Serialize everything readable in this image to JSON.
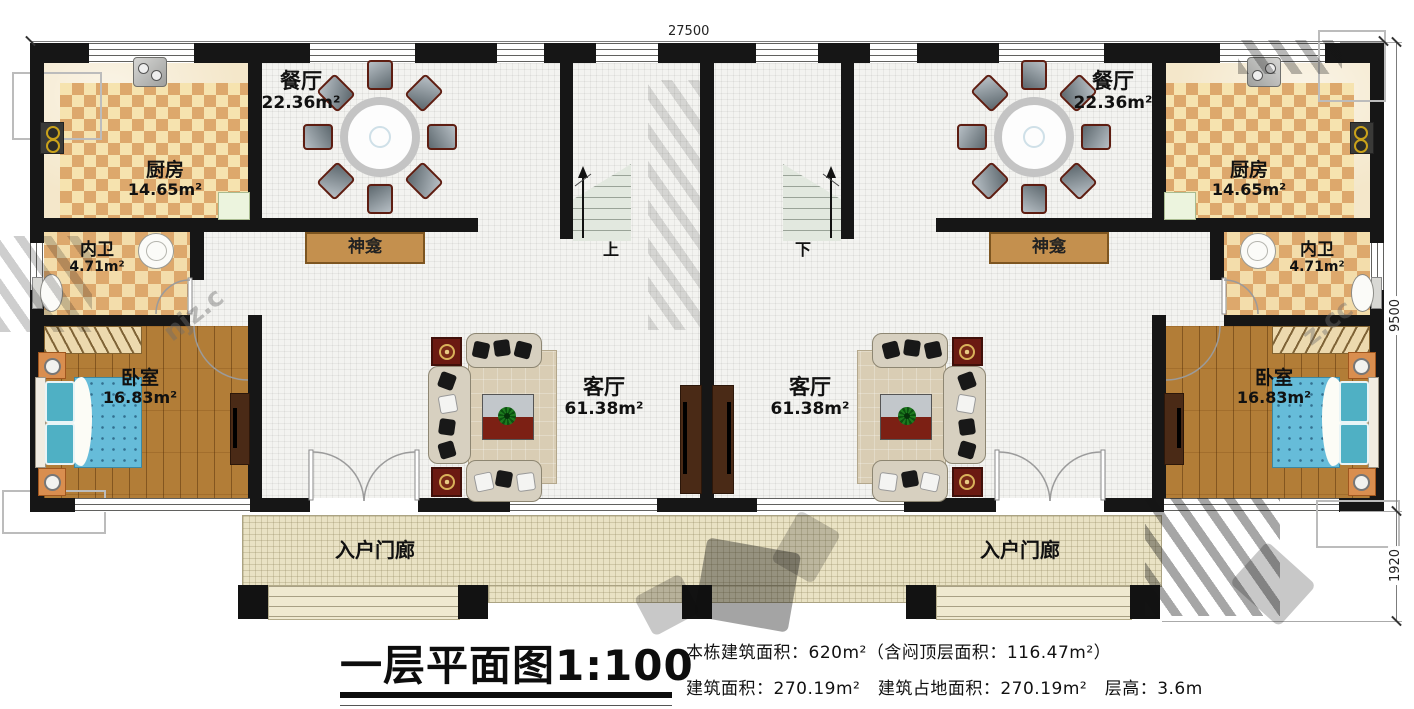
{
  "title": "一层平面图1:100",
  "info": {
    "line1": "本栋建筑面积：620m²（含闷顶层面积：116.47m²）",
    "line2": "建筑面积：270.19m²　建筑占地面积：270.19m²　层高：3.6m"
  },
  "dimensions": {
    "top": "27500",
    "right_main": "9500",
    "right_porch": "1920"
  },
  "watermark": {
    "text1": "njz.c",
    "text2": "z.cc"
  },
  "units": [
    {
      "rooms": {
        "dining": {
          "name": "餐厅",
          "area": "22.36m²"
        },
        "kitchen": {
          "name": "厨房",
          "area": "14.65m²"
        },
        "bath": {
          "name": "内卫",
          "area": "4.71m²"
        },
        "bedroom": {
          "name": "卧室",
          "area": "16.83m²"
        },
        "living": {
          "name": "客厅",
          "area": "61.38m²"
        }
      },
      "shrine": "神龛",
      "stair": "上",
      "porch": "入户门廊"
    },
    {
      "rooms": {
        "dining": {
          "name": "餐厅",
          "area": "22.36m²"
        },
        "kitchen": {
          "name": "厨房",
          "area": "14.65m²"
        },
        "bath": {
          "name": "内卫",
          "area": "4.71m²"
        },
        "bedroom": {
          "name": "卧室",
          "area": "16.83m²"
        },
        "living": {
          "name": "客厅",
          "area": "61.38m²"
        }
      },
      "shrine": "神龛",
      "stair": "下",
      "porch": "入户门廊"
    }
  ]
}
